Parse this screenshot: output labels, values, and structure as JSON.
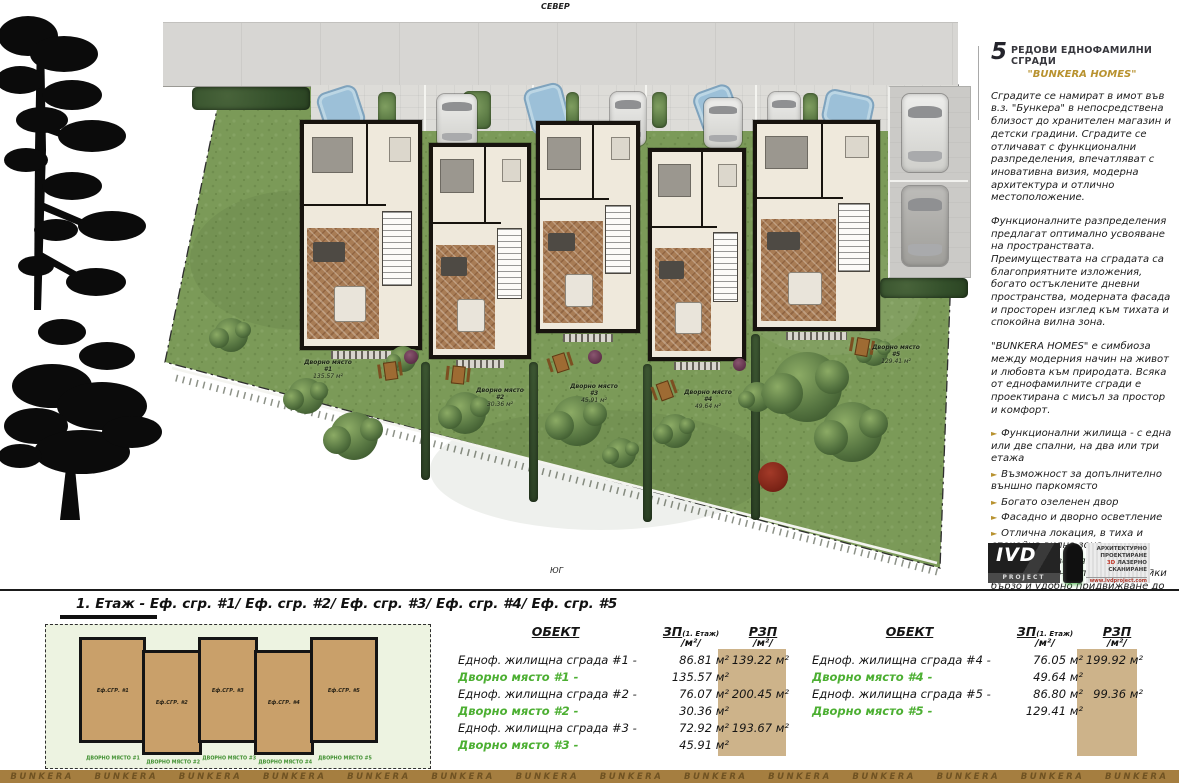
{
  "colors": {
    "accent_gold": "#b8922f",
    "yard_green": "#4caf32",
    "tan_highlight": "#cdb38a",
    "lawn": "#7b9a58",
    "road": "#d7d6d3",
    "strip_brown": "#a57e40"
  },
  "compass": {
    "north": "СЕВЕР",
    "south": "ЮГ"
  },
  "site": {
    "yards": [
      {
        "label": "Дворно място #1",
        "area": "135.57 м²"
      },
      {
        "label": "Дворно място #2",
        "area": "30.36 м²"
      },
      {
        "label": "Дворно място #3",
        "area": "45.91 м²"
      },
      {
        "label": "Дворно място #4",
        "area": "49.64 м²"
      },
      {
        "label": "Дворно място #5",
        "area": "129.41 м²"
      }
    ]
  },
  "sidebar": {
    "title_number": "5",
    "title": "РЕДОВИ ЕДНОФАМИЛНИ СГРАДИ",
    "subtitle": "\"BUNKERA HOMES\"",
    "paragraphs": [
      "Сградите се намират в имот във в.з. \"Бункера\" в непосредствена близост до хранителен магазин и детски градини. Сградите се отличават с функционални разпределения, впечатляват с иновативна визия, модерна архитектура и отлично местоположение.",
      "Функционалните разпределения предлагат оптимално усвояване на пространствата. Преимуществата на сградата са благоприятните изложения, богато остъклените дневни пространства, модерната фасада и просторен изглед към тихата и спокойна вилна зона.",
      "\"BUNKERA HOMES\" е симбиоза между модерния начин на живот и любовта към природата. Всяка от еднофамилните сгради е проектирана с мисъл за простор и комфорт."
    ],
    "bullet_icon": "►",
    "bullets": [
      "Функционални жилища - с една или две спални, на два или три етажа",
      "Възможност за допълнително външно паркомясто",
      "Богато озеленен двор",
      "Фасадно и дворно осветление",
      "Отлична локация, в тиха и спокойна вилна зона",
      "На 2 км разстояние от околовръстен път, осигурявайки бързо и удобно придвижване до всяка точка на града"
    ],
    "logo": {
      "name": "IVD",
      "sub": "PROJECT",
      "l1": "АРХИТЕКТУРНО",
      "l2": "ПРОЕКТИРАНЕ",
      "l3a": "3D",
      "l3b": "ЛАЗЕРНО",
      "l4": "СКАНИРАНЕ",
      "web": "www.ivdproject.com"
    }
  },
  "bottom": {
    "floor_title": "1. Етаж - Еф. сгр. #1/ Еф. сгр. #2/ Еф. сгр. #3/ Еф. сгр. #4/ Еф. сгр. #5",
    "miniplan": {
      "buildings": [
        "Еф.СГР. #1",
        "Еф.СГР. #2",
        "Еф.СГР. #3",
        "Еф.СГР. #4",
        "Еф.СГР. #5"
      ],
      "yards": [
        "ДВОРНО МЯСТО #1",
        "ДВОРНО МЯСТО #2",
        "ДВОРНО МЯСТО #3",
        "ДВОРНО МЯСТО #4",
        "ДВОРНО МЯСТО #5"
      ]
    },
    "tables": [
      {
        "headers": {
          "object": "ОБЕКТ",
          "zp": "ЗП",
          "zp_sub": "(1. Етаж)",
          "unit": "/м²/",
          "rzp": "РЗП"
        },
        "rows": [
          {
            "label": "Едноф. жилищна сграда #1 -",
            "zp": "86.81 м²",
            "rzp": "139.22 м²"
          },
          {
            "label": "Дворно място #1 -",
            "zp": "135.57 м²",
            "rzp": ""
          },
          {
            "label": "Едноф. жилищна сграда #2 -",
            "zp": "76.07 м²",
            "rzp": "200.45 м²"
          },
          {
            "label": "Дворно място #2 -",
            "zp": "30.36 м²",
            "rzp": ""
          },
          {
            "label": "Едноф. жилищна сграда #3 -",
            "zp": "72.92 м²",
            "rzp": "193.67 м²"
          },
          {
            "label": "Дворно място #3 -",
            "zp": "45.91 м²",
            "rzp": ""
          }
        ]
      },
      {
        "headers": {
          "object": "ОБЕКТ",
          "zp": "ЗП",
          "zp_sub": "(1. Етаж)",
          "unit": "/м²/",
          "rzp": "РЗП"
        },
        "rows": [
          {
            "label": "Едноф. жилищна сграда #4 -",
            "zp": "76.05 м²",
            "rzp": "199.92 м²"
          },
          {
            "label": "Дворно място #4 -",
            "zp": "49.64 м²",
            "rzp": ""
          },
          {
            "label": "Едноф. жилищна сграда #5 -",
            "zp": "86.80 м²",
            "rzp": "99.36 м²"
          },
          {
            "label": "Дворно място #5 -",
            "zp": "129.41 м²",
            "rzp": ""
          }
        ]
      }
    ],
    "watermark": "BUNKERA",
    "watermark_count": 14
  }
}
